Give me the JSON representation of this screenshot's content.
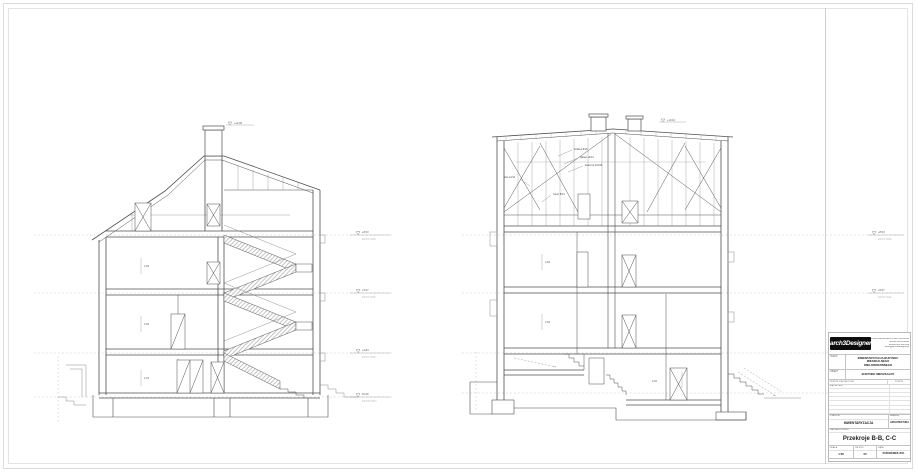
{
  "sheet": {
    "background": "#ffffff",
    "frame_color": "#dcdcdc",
    "line_color": "#4f4f4f",
    "datum_color": "#b8b8b8"
  },
  "drawings": {
    "section_bb": {
      "ridge_level": "+12,96",
      "levels": [
        {
          "elev": "+8,53",
          "name": "poziom stropu"
        },
        {
          "elev": "+5,67",
          "name": "poziom stropu"
        },
        {
          "elev": "+2,84",
          "name": "poziom stropu"
        },
        {
          "elev": "±0,00",
          "name": "poziom parteru"
        }
      ],
      "room_labels": [
        "2,84",
        "2,84",
        "2,62"
      ]
    },
    "section_cc": {
      "chimney_level": "+13,10",
      "levels": [
        {
          "elev": "+8,53",
          "name": "poziom stropu"
        },
        {
          "elev": "+5,67",
          "name": "poziom stropu"
        },
        {
          "elev": "+2,84",
          "name": "poziom stropu"
        },
        {
          "elev": "-1,10",
          "name": "poziom piwnicy"
        }
      ],
      "roof_labels": [
        "krokiew 8/16",
        "płatew 14/14",
        "kleszcze 2×8/16",
        "słup 14/14",
        "miecz 8/14"
      ],
      "room_labels": [
        "2,84",
        "2,84",
        "2,60"
      ]
    }
  },
  "title_block": {
    "logo_text": "arch3Designer",
    "office_lines": [
      "PRACOWNIA ARCHITEKTONICZNA",
      "50-000 WROCŁAW",
      "tel./fax 000 000 000",
      "biuro@arch3designer.pl"
    ],
    "temat_label": "TEMAT",
    "temat_line1": "INWENTARYZACJA BUDYNKU MIESZKALNEGO",
    "temat_line2": "WIELORODZINNEGO",
    "obiekt_label": "OBIEKT",
    "obiekt_value": "BUDYNEK MIESZKALNY",
    "team_header_left": "ZESPÓŁ PROJEKTOWY",
    "team_header_right": "PODPIS",
    "team_row1": "mgr inż. arch.",
    "stadium_label": "STADIUM",
    "stadium_value": "INWENTARYZACJA",
    "branza_label": "BRANŻA",
    "branza_value": "ARCHITEKTURA",
    "drawing_label": "NAZWA RYSUNKU",
    "drawing_title": "Przekroje B-B, C-C",
    "skala_label": "SKALA",
    "skala_value": "1:50",
    "nr_label": "NR RYS.",
    "nr_value": "05",
    "data_label": "DATA",
    "data_value": "PAŹDZIERNIK 2011"
  }
}
